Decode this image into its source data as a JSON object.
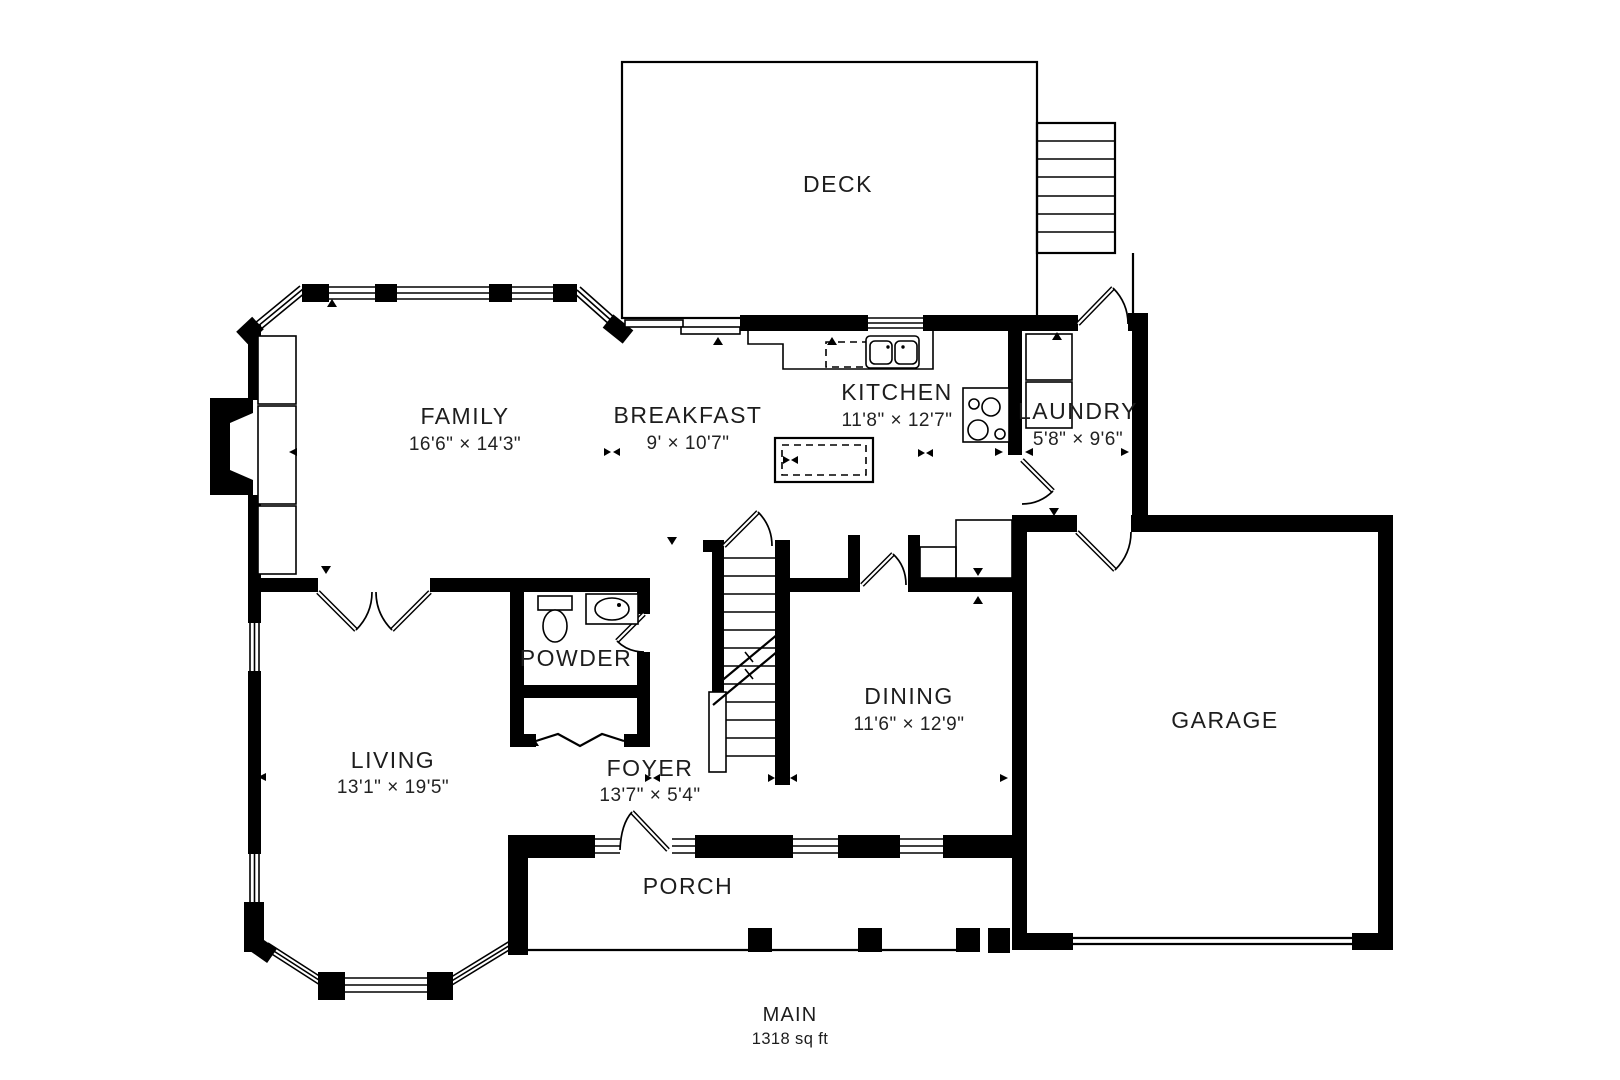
{
  "plan": {
    "summary": {
      "level": "MAIN",
      "area": "1318 sq ft"
    },
    "rooms": {
      "deck": {
        "name": "DECK"
      },
      "family": {
        "name": "FAMILY",
        "dims": "16'6\" × 14'3\""
      },
      "breakfast": {
        "name": "BREAKFAST",
        "dims": "9' × 10'7\""
      },
      "kitchen": {
        "name": "KITCHEN",
        "dims": "11'8\" × 12'7\""
      },
      "laundry": {
        "name": "LAUNDRY",
        "dims": "5'8\" × 9'6\""
      },
      "powder": {
        "name": "POWDER"
      },
      "living": {
        "name": "LIVING",
        "dims": "13'1\" × 19'5\""
      },
      "foyer": {
        "name": "FOYER",
        "dims": "13'7\" × 5'4\""
      },
      "dining": {
        "name": "DINING",
        "dims": "11'6\" × 12'9\""
      },
      "garage": {
        "name": "GARAGE"
      },
      "porch": {
        "name": "PORCH"
      }
    },
    "colors": {
      "wall": "#000000",
      "background": "#ffffff",
      "text": "#1d1d1d"
    }
  }
}
